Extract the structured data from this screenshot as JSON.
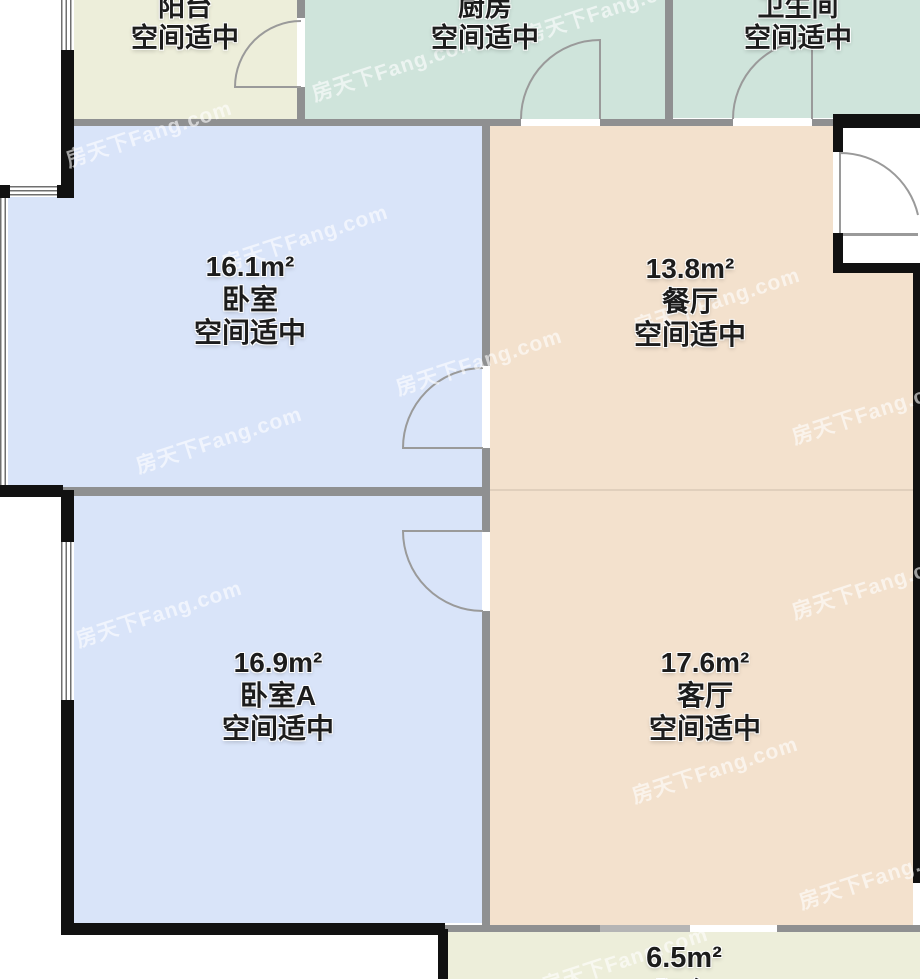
{
  "watermark": {
    "text": "房天下Fang.com"
  },
  "rooms": {
    "balcony_top": {
      "name": "阳台",
      "status": "空间适中"
    },
    "kitchen": {
      "name": "厨房",
      "status": "空间适中"
    },
    "bathroom": {
      "name": "卫生间",
      "status": "空间适中"
    },
    "bedroom": {
      "area": "16.1m²",
      "name": "卧室",
      "status": "空间适中"
    },
    "dining": {
      "area": "13.8m²",
      "name": "餐厅",
      "status": "空间适中"
    },
    "bedroom_a": {
      "area": "16.9m²",
      "name": "卧室A",
      "status": "空间适中"
    },
    "living": {
      "area": "17.6m²",
      "name": "客厅",
      "status": "空间适中"
    },
    "balcony_bottom": {
      "area": "6.5m²",
      "name": "阳台"
    }
  },
  "colors": {
    "balcony_fill": "#edeeda",
    "kitchen_bathroom_fill": "#cfe4db",
    "bedroom_fill": "#d9e4f9",
    "living_dining_fill": "#f3e1cd",
    "wall_black": "#111111",
    "wall_gray": "#8f9091",
    "door_line": "#9a9a9a",
    "label_text": "#1c1c1c"
  }
}
